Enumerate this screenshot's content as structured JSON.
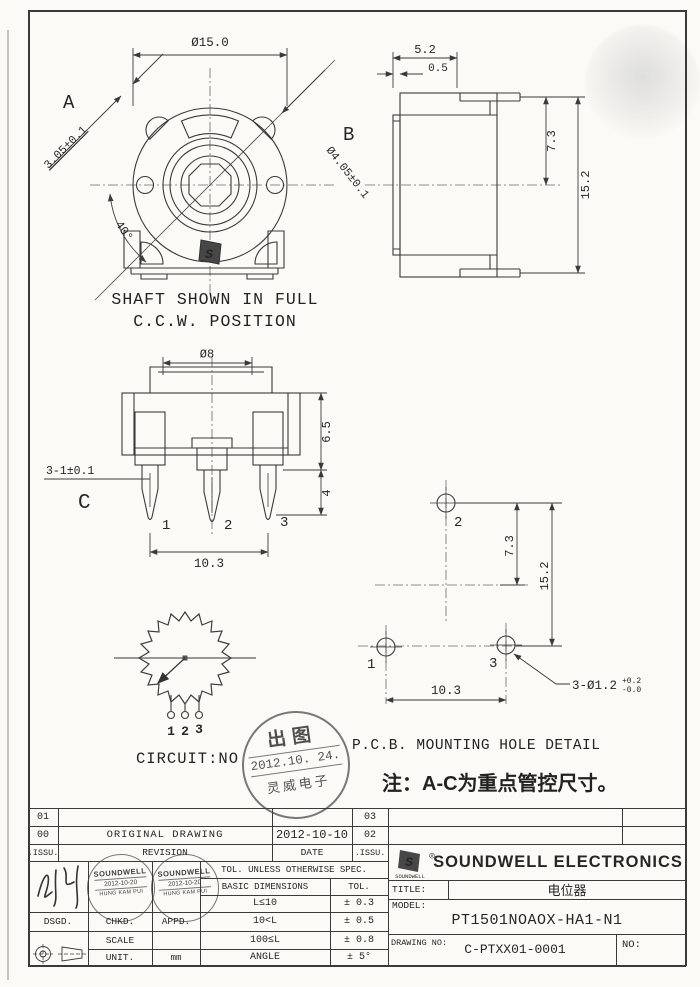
{
  "front_view": {
    "label_a": "A",
    "dim_slot": "3.05±0.1",
    "dim_od": "Ø15.0",
    "label_b": "B",
    "dim_shaft": "Ø4.05±0.1",
    "dim_angle": "40°",
    "logo_s": "S",
    "caption1": "SHAFT SHOWN IN FULL",
    "caption2": "C.C.W. POSITION"
  },
  "side_view": {
    "dim_width": "5.2",
    "dim_plate": "0.5",
    "dim_upper": "7.3",
    "dim_height": "15.2"
  },
  "pin_view": {
    "dim_shaft": "Ø8",
    "dim_body": "6.5",
    "dim_tip": "4",
    "dim_pins": "3-1±0.1",
    "label_c": "C",
    "pins": [
      "1",
      "2",
      "3"
    ],
    "dim_pitch": "10.3"
  },
  "pcb_view": {
    "caption": "P.C.B. MOUNTING HOLE DETAIL",
    "holes": [
      "1",
      "2",
      "3"
    ],
    "dim_upper": "7.3",
    "dim_height": "15.2",
    "dim_pitch": "10.3",
    "dim_holes": "3-Ø1.2",
    "tol_plus": "+0.2",
    "tol_minus": "-0.0"
  },
  "circuit": {
    "caption": "CIRCUIT:NO",
    "pins": [
      "1",
      "2",
      "3"
    ]
  },
  "note": "注：A-C为重点管控尺寸。",
  "release_stamp": {
    "top": "出图",
    "date": "2012.10. 24.",
    "bottom": "灵威电子"
  },
  "revision": {
    "col_issu": ".ISSU.",
    "col_revision": "REVISION",
    "col_date": "DATE",
    "col_issu2": ".ISSU.",
    "rows": [
      {
        "issu": "01",
        "rev": "",
        "date": "",
        "issu2": "03"
      },
      {
        "issu": "00",
        "rev": "ORIGINAL DRAWING",
        "date": "2012-10-10",
        "issu2": "02"
      }
    ]
  },
  "company": {
    "name": "SOUNDWELL ELECTRONICS",
    "logo": "SOUNDWELL",
    "logo_s": "S",
    "reg": "◎"
  },
  "titleblock": {
    "title_label": "TITLE:",
    "title": "电位器",
    "model_label": "MODEL:",
    "model": "PT1501NOAOX-HA1-N1",
    "drawing_label": "DRAWING NO:",
    "drawing_no": "C-PTXX01-0001",
    "no_label": "NO:",
    "dsgd": "DSGD.",
    "chkd": "CHKD.",
    "appd": "APPD.",
    "scale": "SCALE",
    "unit": "UNIT.",
    "unit_val": "mm",
    "tol_header": "TOL. UNLESS OTHERWISE SPEC.",
    "basic": "BASIC DIMENSIONS",
    "tol": "TOL.",
    "tol_rows": [
      {
        "range": "L≤10",
        "tol": "± 0.3"
      },
      {
        "range": "10<L",
        "tol": "± 0.5"
      },
      {
        "range": "100≤L",
        "tol": "± 0.8"
      },
      {
        "range": "ANGLE",
        "tol": "± 5°"
      }
    ],
    "appr_stamp": {
      "l1": "SOUNDWELL",
      "l2": "2012-10-20",
      "l3": "HUNG KAM PUI"
    }
  }
}
